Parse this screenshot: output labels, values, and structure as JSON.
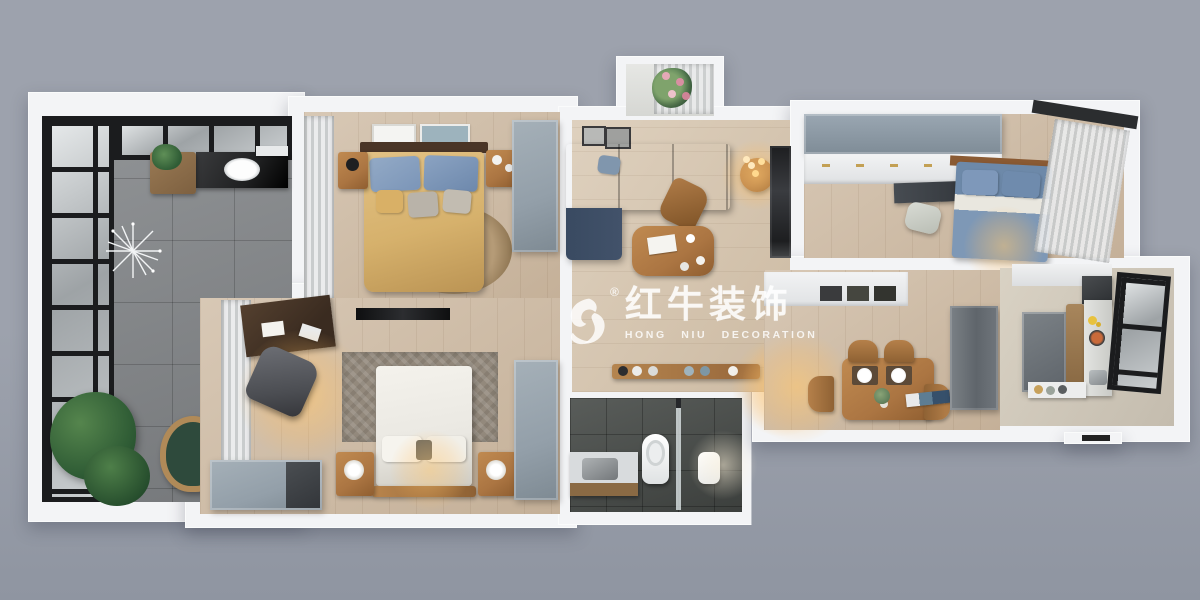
{
  "watermark": {
    "registered_mark": "®",
    "title": "红牛装饰",
    "subtitle": "HONG NIU DECORATION",
    "logo_icon": "bull-logo-icon"
  },
  "colors": {
    "bg_top": "#9da2ad",
    "bg_bottom": "#8f95a1",
    "wall": "#f3f4f6",
    "wood_floor": "#cfbca5",
    "wood_floor_2": "#d6c5ae",
    "tile_floor": "#85888b",
    "bath_floor": "#4b4f4c",
    "glass": "#c6cacc",
    "frame_black": "#1b1c1e",
    "sofa_navy": "#42526a",
    "duvet_yellow": "#d6b16c",
    "pillow_blue": "#7b95b8",
    "bed_blue": "#7e98b6",
    "bed_white": "#eae8e2",
    "wardrobe_gray": "#939fa9",
    "wood_furniture": "#ab7542",
    "desk_dark": "#3a2b20",
    "plant_green": "#2f5c35",
    "marble_dark": "#1f2021",
    "glow_warm": "#ffc268",
    "watermark_white": "rgba(255,255,255,0.82)"
  },
  "rooms": [
    {
      "id": "sunroom-balcony",
      "floor": "gray-tile",
      "items": [
        "black-grid-window",
        "skylight-grid",
        "vanity-sink",
        "mirror-cabinet",
        "plant-shelf",
        "sputnik-chandelier",
        "hanging-chair",
        "large-plants"
      ]
    },
    {
      "id": "master-bedroom",
      "floor": "wood",
      "items": [
        "curtain",
        "wall-art",
        "double-bed-yellow",
        "blue-pillows",
        "nightstand",
        "round-rug",
        "wardrobe"
      ]
    },
    {
      "id": "second-bedroom",
      "floor": "wood",
      "items": [
        "curtain",
        "desk",
        "office-chair",
        "tv",
        "rug",
        "double-bed-white",
        "nightstand",
        "dresser",
        "wardrobe"
      ]
    },
    {
      "id": "living-room",
      "floor": "wood",
      "items": [
        "balcony-flowers",
        "sheer-curtain",
        "leaning-art-frames",
        "sectional-sofa",
        "armchair",
        "coffee-table",
        "side-table",
        "pendant-lamp",
        "tv-wall"
      ]
    },
    {
      "id": "hallway",
      "floor": "wood",
      "items": [
        "console-shelf",
        "decor-objects"
      ]
    },
    {
      "id": "bathroom",
      "floor": "dark-tile",
      "items": [
        "vanity",
        "toilet",
        "shower-glass",
        "towel"
      ]
    },
    {
      "id": "third-bedroom",
      "floor": "wood",
      "items": [
        "wardrobe-top",
        "white-cabinets",
        "desk",
        "desk-chair",
        "double-bed-blue",
        "sheer-curtain",
        "window-frame"
      ]
    },
    {
      "id": "dining-room",
      "floor": "wood",
      "items": [
        "sideboard",
        "wall-trays",
        "dining-table",
        "dining-chairs",
        "vase-flowers",
        "fridge",
        "magazines"
      ]
    },
    {
      "id": "kitchen",
      "floor": "wood",
      "items": [
        "upper-cabinets",
        "range-hood",
        "tall-cabinet",
        "wood-panel",
        "counter",
        "stove-pan",
        "sink",
        "window",
        "fruit-counter"
      ]
    }
  ]
}
